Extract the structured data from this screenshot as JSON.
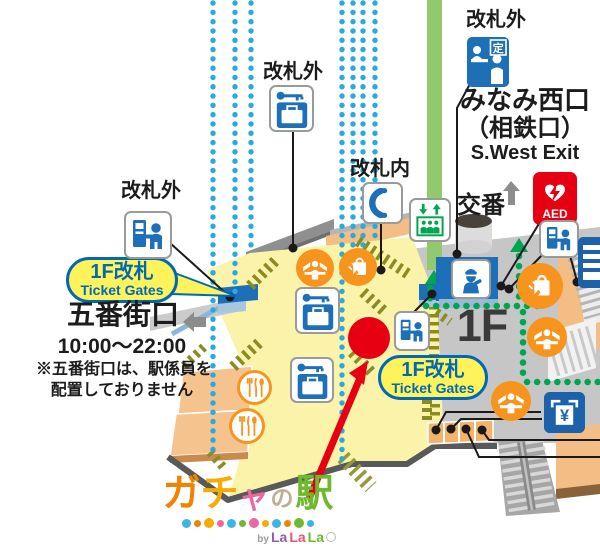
{
  "map": {
    "labels": {
      "outside_gate_left": "改札外",
      "outside_gate_top": "改札外",
      "inside_gate": "改札内",
      "outside_gate_right": "改札外",
      "exit_name_jp": "みなみ西口",
      "exit_name_jp2": "（相鉄口）",
      "exit_name_en": "S.West Exit",
      "police_box": "交番",
      "floor": "1F"
    },
    "bubbles": {
      "left": {
        "line1": "1F改札",
        "line2": "Ticket Gates"
      },
      "right": {
        "line1": "1F改札",
        "line2": "Ticket Gates"
      }
    },
    "gobangai": {
      "name": "五番街口",
      "hours": "10:00～22:00",
      "note1": "※五番街口は、駅係員を",
      "note2": "配置しておりません"
    },
    "icon_texts": {
      "aed": "AED",
      "commuter_pass": "定",
      "yen": "¥"
    },
    "colors": {
      "track_dots_blue": "#29a9e1",
      "route_dots_green": "#00a551",
      "floor_yellow": "#faf3a9",
      "floor_gray": "#c6c6c6",
      "wall_tan": "#f2be86",
      "marker_red": "#e60012",
      "bubble_yellow": "#fff35c",
      "bubble_blue": "#0068b7",
      "icon_blue": "#1d70b7",
      "icon_orange": "#f7941d"
    }
  },
  "logo": {
    "c1": "ガ",
    "c2": "チ",
    "c3": "ャ",
    "c4": "の",
    "c5": "駅",
    "by": "by",
    "la1": "La",
    "la2": "La",
    "la3": "La"
  }
}
